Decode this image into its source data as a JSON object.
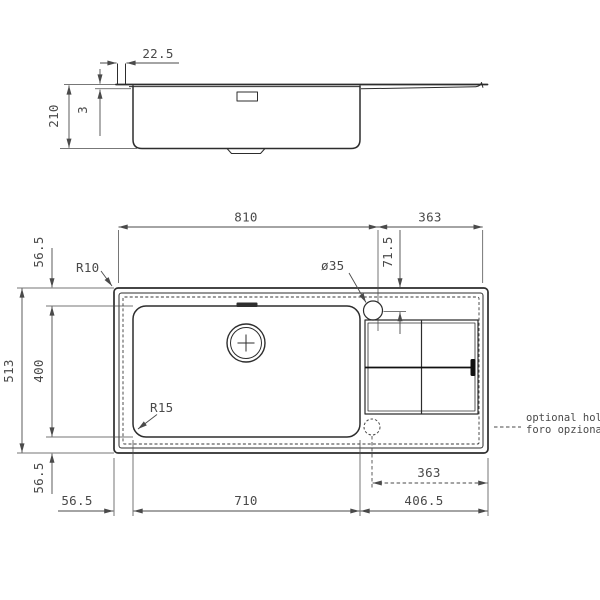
{
  "drawing_title": "sink technical drawing",
  "units": "mm",
  "side_view": {
    "rim_width": "22.5",
    "rim_thickness": "3",
    "bowl_depth": "210"
  },
  "plan_view": {
    "width_left": "810",
    "width_right": "363",
    "tap_hole_offset": "71.5",
    "tap_hole_diameter": "ø35",
    "outer_corner_radius": "R10",
    "bowl_corner_radius": "R15",
    "top_edge_offset": "56.5",
    "overall_depth": "513",
    "bowl_front_depth": "400",
    "bottom_edge_offset_v": "56.5",
    "bottom_edge_offset_h": "56.5",
    "bowl_width": "710",
    "optional_hole_offset": "363",
    "drainer_section_width": "406.5"
  },
  "notes": {
    "optional_hole_en": "optional hole",
    "optional_hole_it": "foro opzionale"
  }
}
